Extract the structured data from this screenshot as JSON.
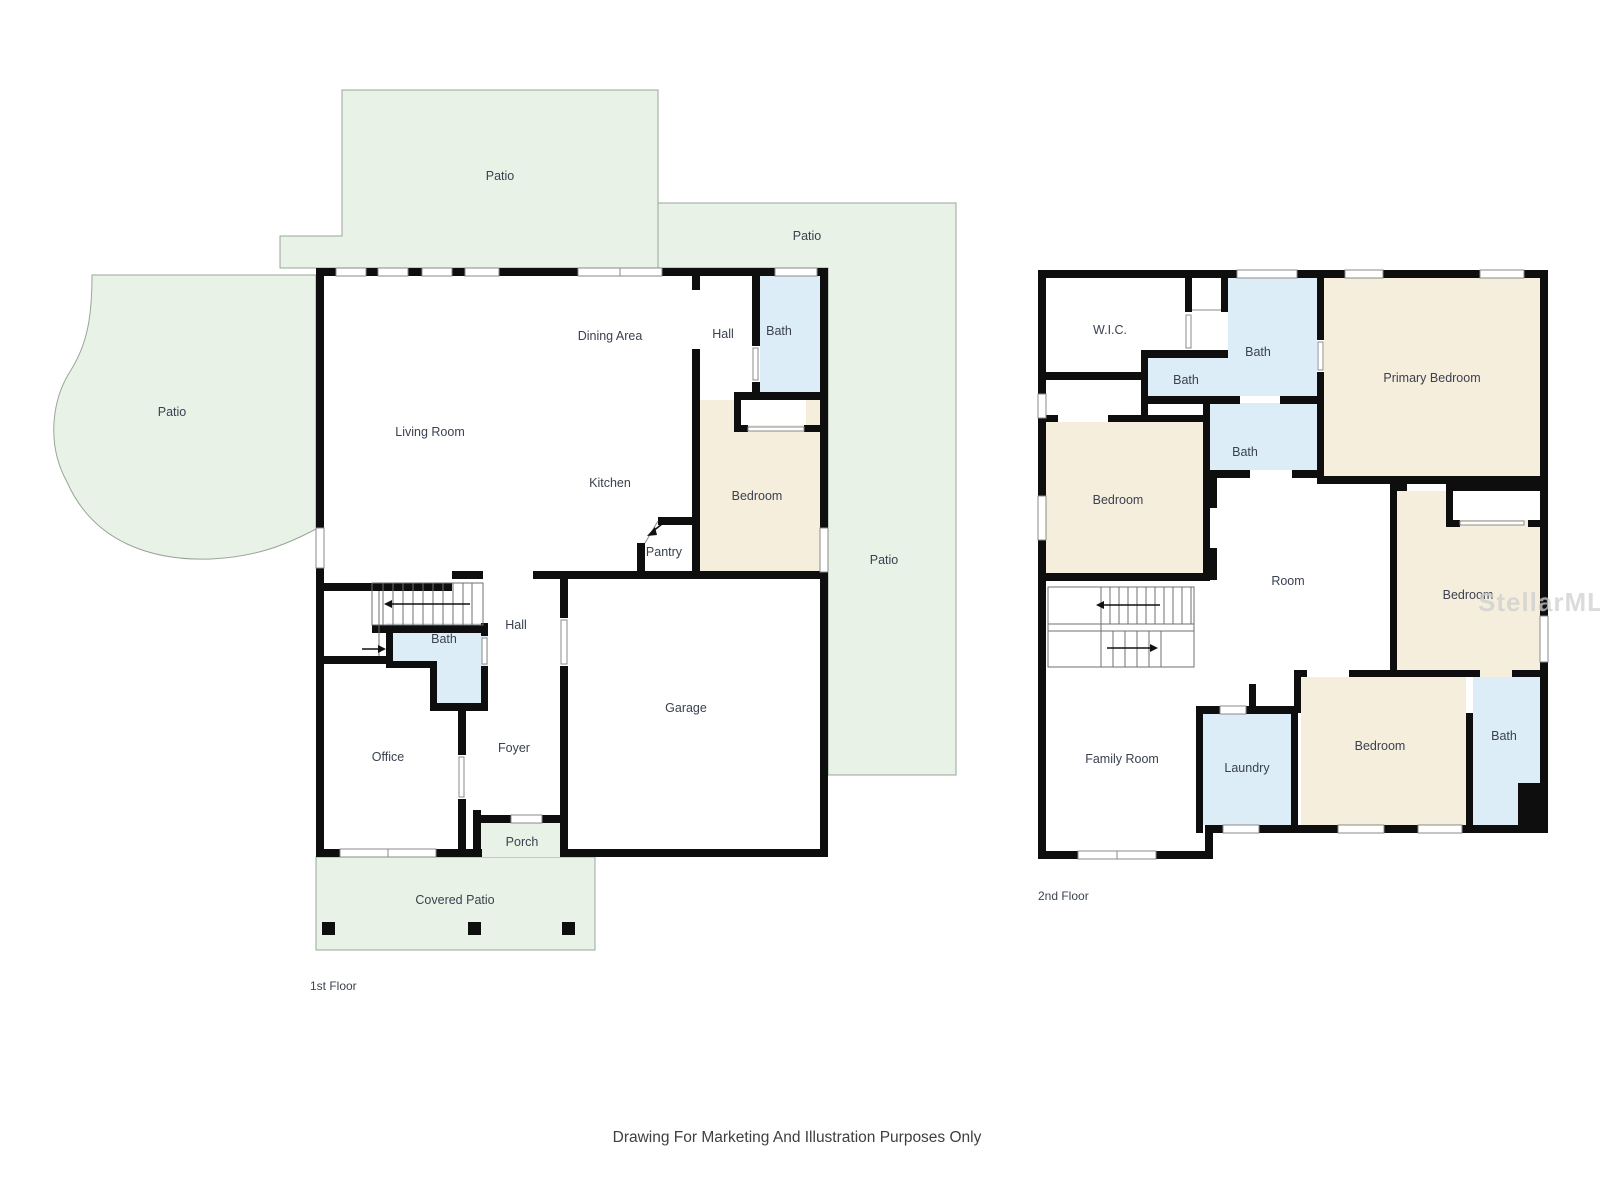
{
  "disclaimer": "Drawing For Marketing And Illustration Purposes Only",
  "watermark": "StellarMLS",
  "colors": {
    "patio_fill": "#e9f2e6",
    "bath_fill": "#ddedf8",
    "bedroom_fill": "#f6eedd",
    "wall": "#0e0e0e",
    "label_text": "#3a4150",
    "watermark_text": "#cfcfcf"
  },
  "floor1": {
    "label": "1st Floor",
    "rooms": {
      "patio_top": "Patio",
      "patio_top_right": "Patio",
      "patio_left": "Patio",
      "patio_right": "Patio",
      "living_room": "Living Room",
      "dining_area": "Dining Area",
      "kitchen": "Kitchen",
      "hall_top": "Hall",
      "bath_top": "Bath",
      "bedroom": "Bedroom",
      "pantry": "Pantry",
      "hall": "Hall",
      "bath": "Bath",
      "office": "Office",
      "foyer": "Foyer",
      "garage": "Garage",
      "porch": "Porch",
      "covered_patio": "Covered Patio"
    }
  },
  "floor2": {
    "label": "2nd Floor",
    "rooms": {
      "wic": "W.I.C.",
      "bath_top": "Bath",
      "bath_small": "Bath",
      "bath_mid": "Bath",
      "primary_bedroom": "Primary Bedroom",
      "bedroom_left": "Bedroom",
      "room": "Room",
      "bedroom_right": "Bedroom",
      "family_room": "Family Room",
      "laundry": "Laundry",
      "bedroom_bottom": "Bedroom",
      "bath_bottom": "Bath"
    }
  }
}
